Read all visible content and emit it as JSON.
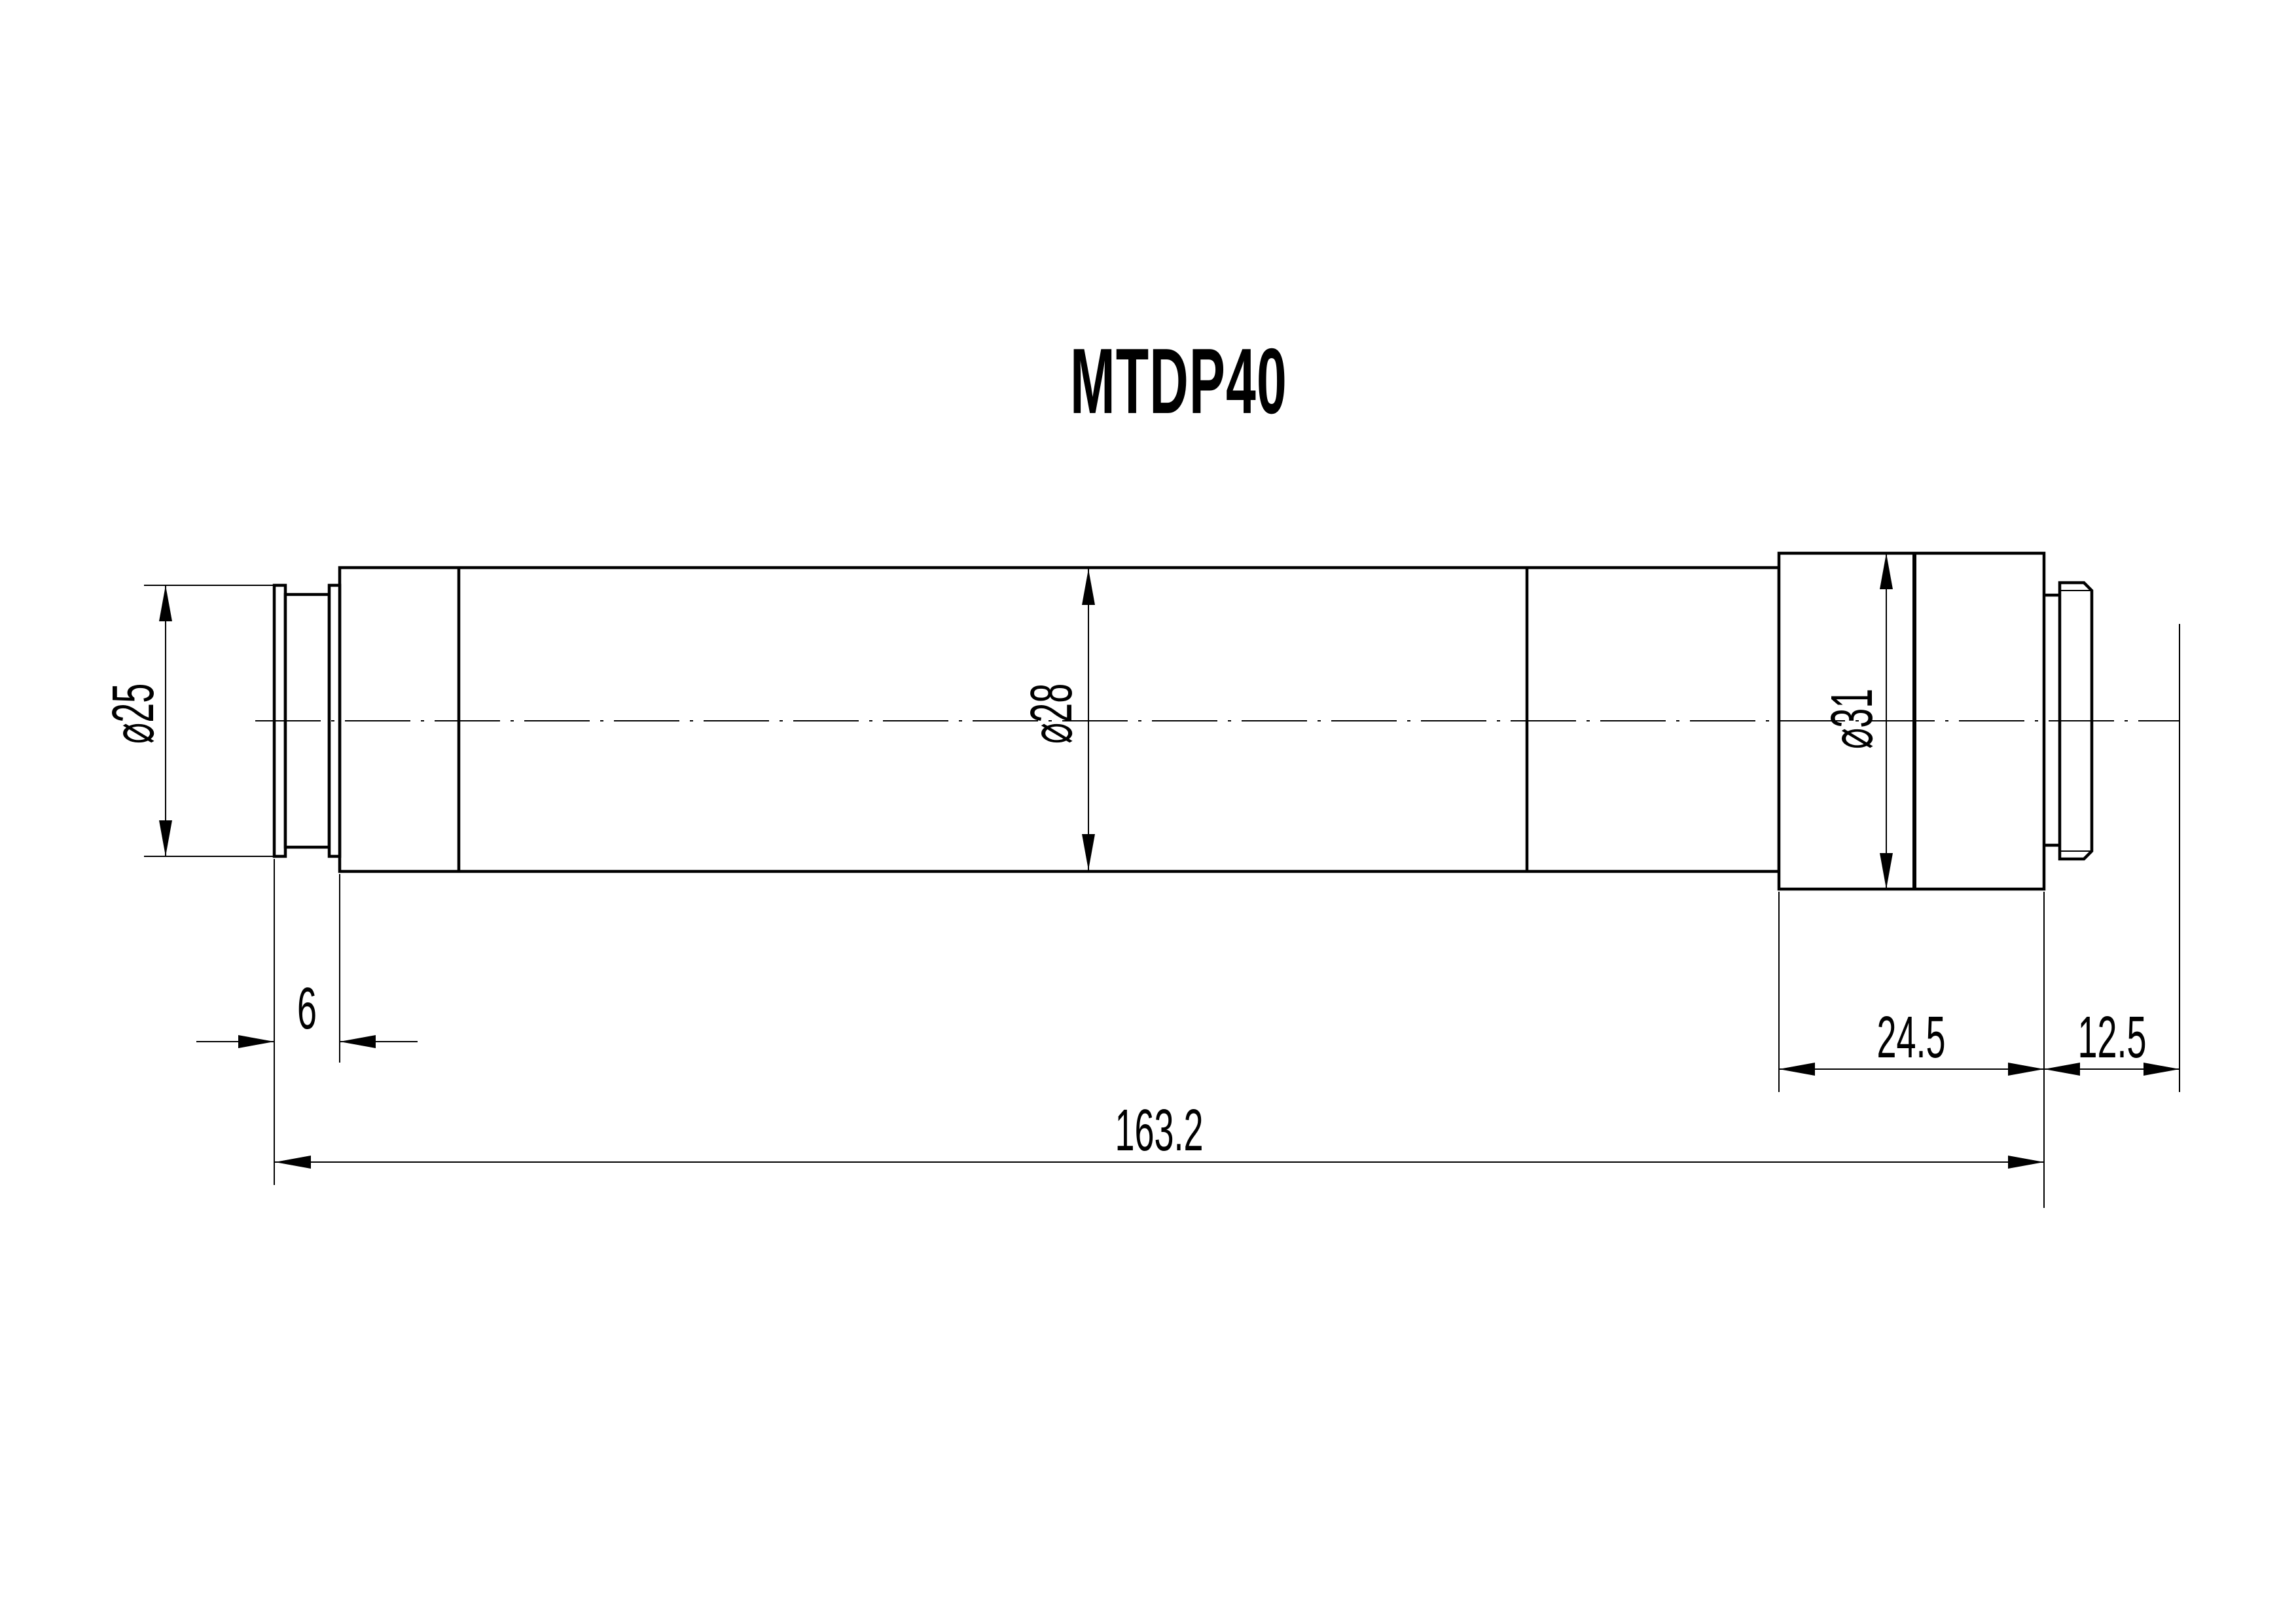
{
  "title": {
    "text": "MTDP40"
  },
  "drawing": {
    "type": "mechanical-dimension-drawing",
    "part": "cylindrical lens barrel, side view",
    "colors": {
      "ink": "#000000",
      "background": "#ffffff"
    }
  },
  "dimensions": {
    "dia25": {
      "label": "⌀25",
      "value": 25,
      "kind": "diameter",
      "applies_to": "left mounting ring"
    },
    "dia28": {
      "label": "⌀28",
      "value": 28,
      "kind": "diameter",
      "applies_to": "main body"
    },
    "dia31": {
      "label": "⌀31",
      "value": 31,
      "kind": "diameter",
      "applies_to": "right block"
    },
    "len6": {
      "label": "6",
      "value": 6,
      "kind": "length",
      "applies_to": "left ring group width"
    },
    "len245": {
      "label": "24.5",
      "value": 24.5,
      "kind": "length",
      "applies_to": "right block width"
    },
    "len125": {
      "label": "12.5",
      "value": 12.5,
      "kind": "length",
      "applies_to": "block face to rear reference plane"
    },
    "len1632": {
      "label": "163.2",
      "value": 163.2,
      "kind": "length",
      "applies_to": "overall length"
    }
  }
}
